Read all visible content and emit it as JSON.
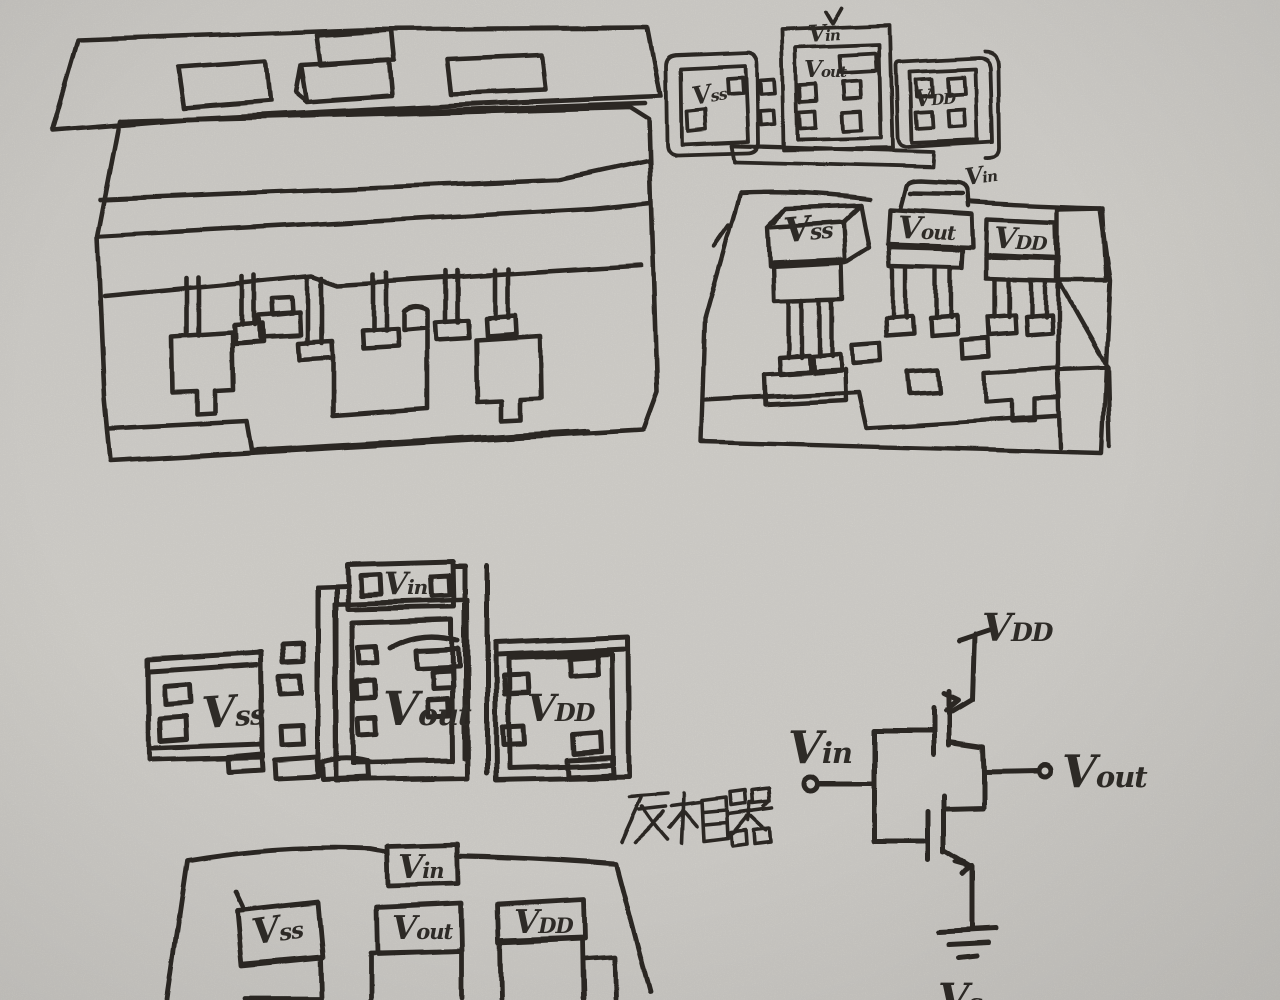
{
  "paper": {
    "background": "#d6d4cf",
    "ink": "#2e2b27"
  },
  "figures": {
    "layout_small": {
      "labels": {
        "vin": "Vin",
        "vss": "Vss",
        "vout": "Vout",
        "vdd": "VDD"
      }
    },
    "package_right": {
      "labels": {
        "vin": "Vin",
        "vss": "Vss",
        "vout": "Vout",
        "vdd": "VDD"
      }
    },
    "layout_large": {
      "labels": {
        "vin": "Vin",
        "vss": "Vss",
        "vout": "Vout",
        "vdd": "VDD"
      }
    },
    "annotation": {
      "text": "反相器"
    },
    "schematic": {
      "labels": {
        "vdd": "VDD",
        "vin": "Vin",
        "vout": "Vout",
        "vss_partial": "Vs"
      }
    },
    "package_bottom": {
      "labels": {
        "vin": "Vin",
        "vss": "Vss",
        "vout": "Vout",
        "vdd": "VDD"
      }
    }
  }
}
